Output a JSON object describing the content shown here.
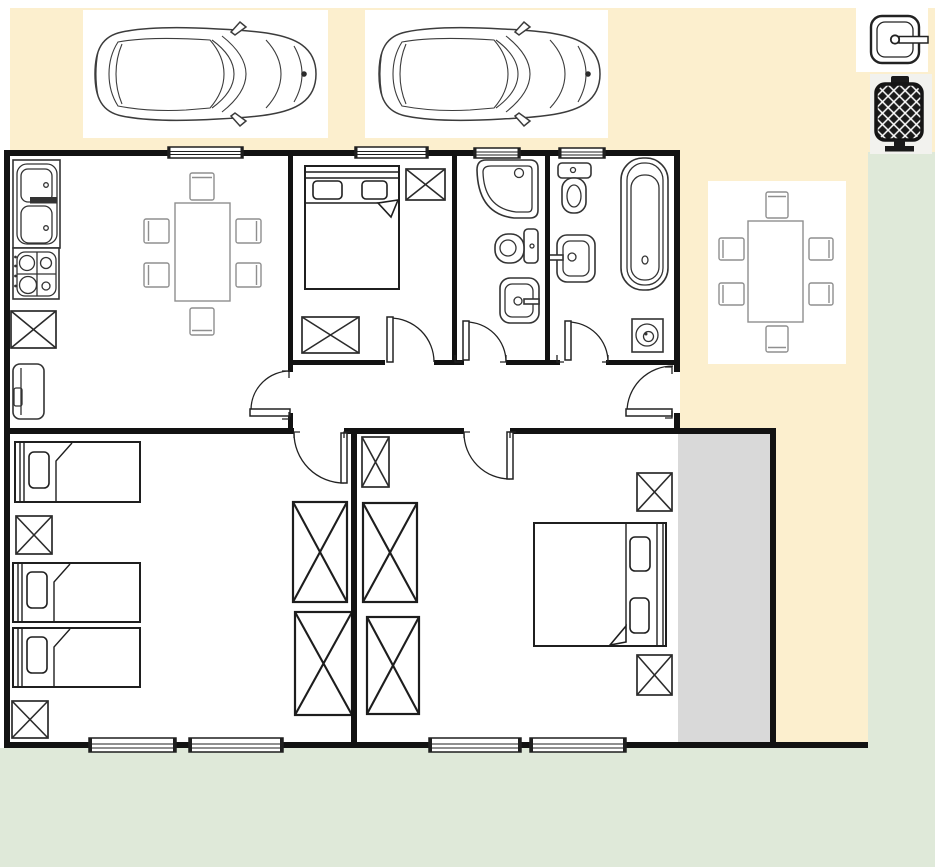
{
  "title": "House floor plan with driveway, garden, two parked cars and outdoor dining set",
  "colors": {
    "page_bg": "#ffffff",
    "driveway": "#fcefce",
    "garden": "#dfe9d9",
    "balcony": "#d9d9d9",
    "wall": "#121212",
    "fixture": "#333333",
    "furn": "#1f1f1f",
    "dining": "#8f8f8f",
    "icon_dark": "#1a1a1a",
    "icon_patch": "#f2f2ee"
  },
  "plan": {
    "rooms": [
      {
        "name": "kitchen-living-room",
        "furniture": [
          "double-sink-counter",
          "gas-stove-4-burners",
          "cabinet-x",
          "refrigerator",
          "dining-table-6-chairs"
        ]
      },
      {
        "name": "bedroom-top",
        "furniture": [
          "double-bed",
          "cabinet-x-small",
          "cabinet-x-wide"
        ]
      },
      {
        "name": "bathroom-1",
        "furniture": [
          "corner-shower",
          "toilet",
          "washbasin"
        ]
      },
      {
        "name": "bathroom-2",
        "furniture": [
          "toilet",
          "washbasin",
          "bathtub",
          "washer-floor-drain"
        ]
      },
      {
        "name": "hallway",
        "furniture": []
      },
      {
        "name": "bedroom-bottom-left",
        "furniture": [
          "single-bed",
          "single-bed",
          "single-bed",
          "nightstand-x",
          "nightstand-x",
          "wardrobe-x",
          "wardrobe-x"
        ]
      },
      {
        "name": "bedroom-bottom-right",
        "furniture": [
          "double-bed",
          "cabinet-x-small",
          "wardrobe-x",
          "wardrobe-x",
          "nightstand-x",
          "nightstand-x"
        ]
      },
      {
        "name": "balcony",
        "furniture": []
      }
    ],
    "doors": [
      "living-to-hall",
      "hall-to-outdoor",
      "bedroom-top",
      "bathroom-1",
      "bathroom-2",
      "bedroom-bottom-left",
      "bedroom-bottom-right"
    ],
    "windows_count": 8,
    "outdoor": {
      "driveway_cars": 2,
      "patio_dining_table_chairs": 6,
      "garden": true
    },
    "corner_icons": [
      "sink-icon",
      "grill-icon"
    ]
  }
}
